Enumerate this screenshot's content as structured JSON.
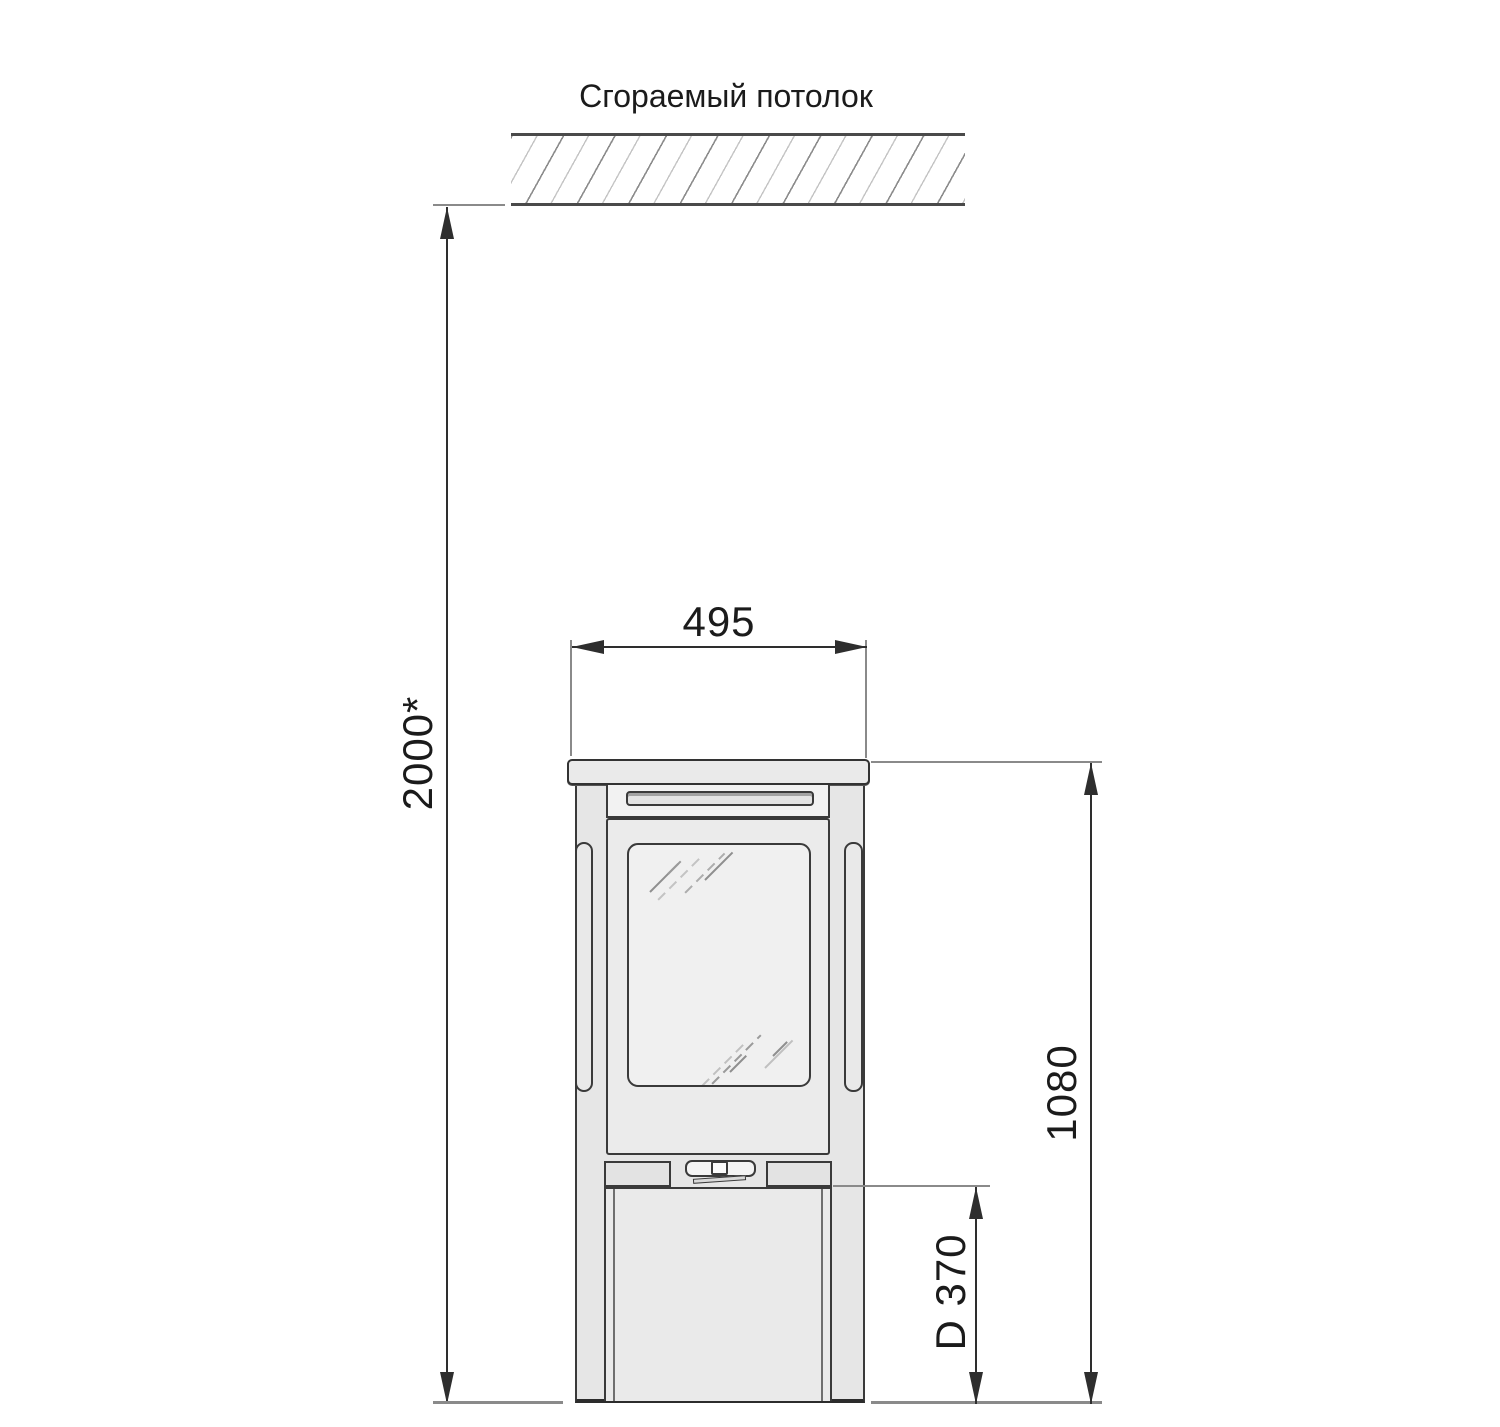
{
  "page": {
    "background": "#ffffff",
    "width_px": 1500,
    "height_px": 1427
  },
  "labels": {
    "ceiling": "Сгораемый потолок",
    "dim_ceiling_clearance": "2000*",
    "dim_stove_width": "495",
    "dim_stove_height": "1080",
    "dim_flue_center_height": "D 370"
  },
  "colors": {
    "outline": "#3a3a3a",
    "dimension_line": "#2e2e2e",
    "extension_line": "#8a8a8a",
    "hatch_line": "#8c8c8c",
    "body_fill": "#e6e6e6",
    "panel_fill": "#ebebeb",
    "glass_fill": "#f0f0f0",
    "text": "#1b1b1b"
  }
}
